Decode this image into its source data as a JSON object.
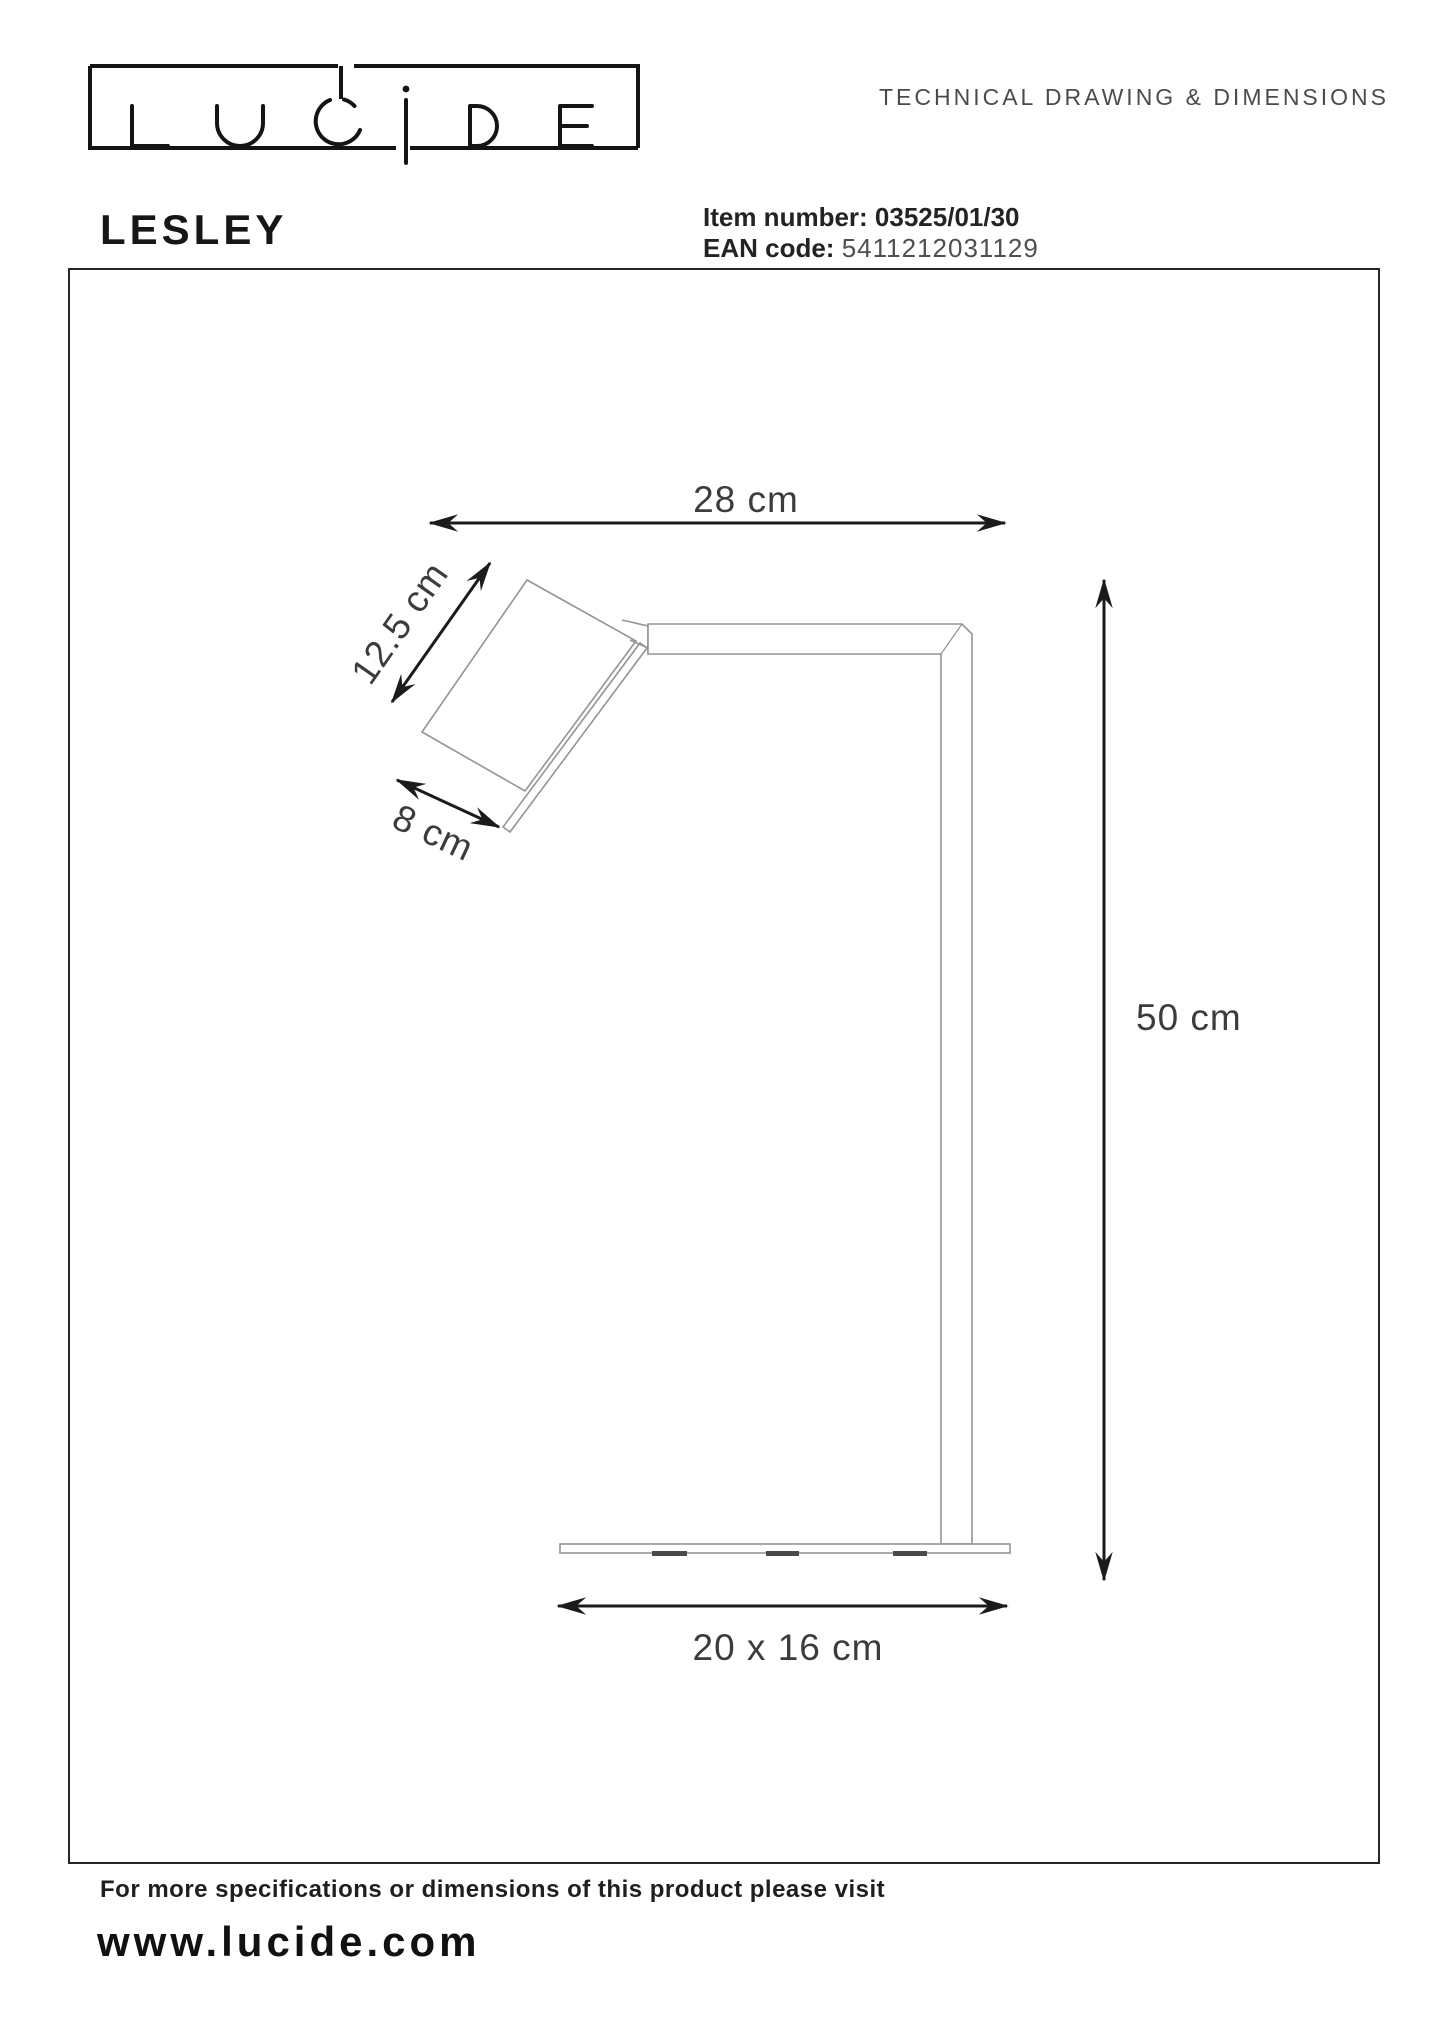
{
  "header": {
    "logo": "LUCIDE",
    "logo_letters": {
      "l": "L",
      "u": "U",
      "c": "C",
      "i": "i",
      "d": "D",
      "e": "E"
    },
    "tagline": "TECHNICAL DRAWING & DIMENSIONS"
  },
  "product": {
    "name": "LESLEY",
    "item_label": "Item number:",
    "item_value": "03525/01/30",
    "ean_label": "EAN code:",
    "ean_value": "5411212031129"
  },
  "drawing": {
    "dim_arm_width": "28 cm",
    "dim_shade_length": "12.5 cm",
    "dim_shade_width": "8 cm",
    "dim_height": "50 cm",
    "dim_base": "20 x 16 cm"
  },
  "footer": {
    "line": "For more specifications or dimensions of this product please visit",
    "url": "www.lucide.com"
  },
  "colors": {
    "ink": "#1b1b1b",
    "muted_text": "#4b4b4b",
    "drawing_line": "#949494"
  }
}
